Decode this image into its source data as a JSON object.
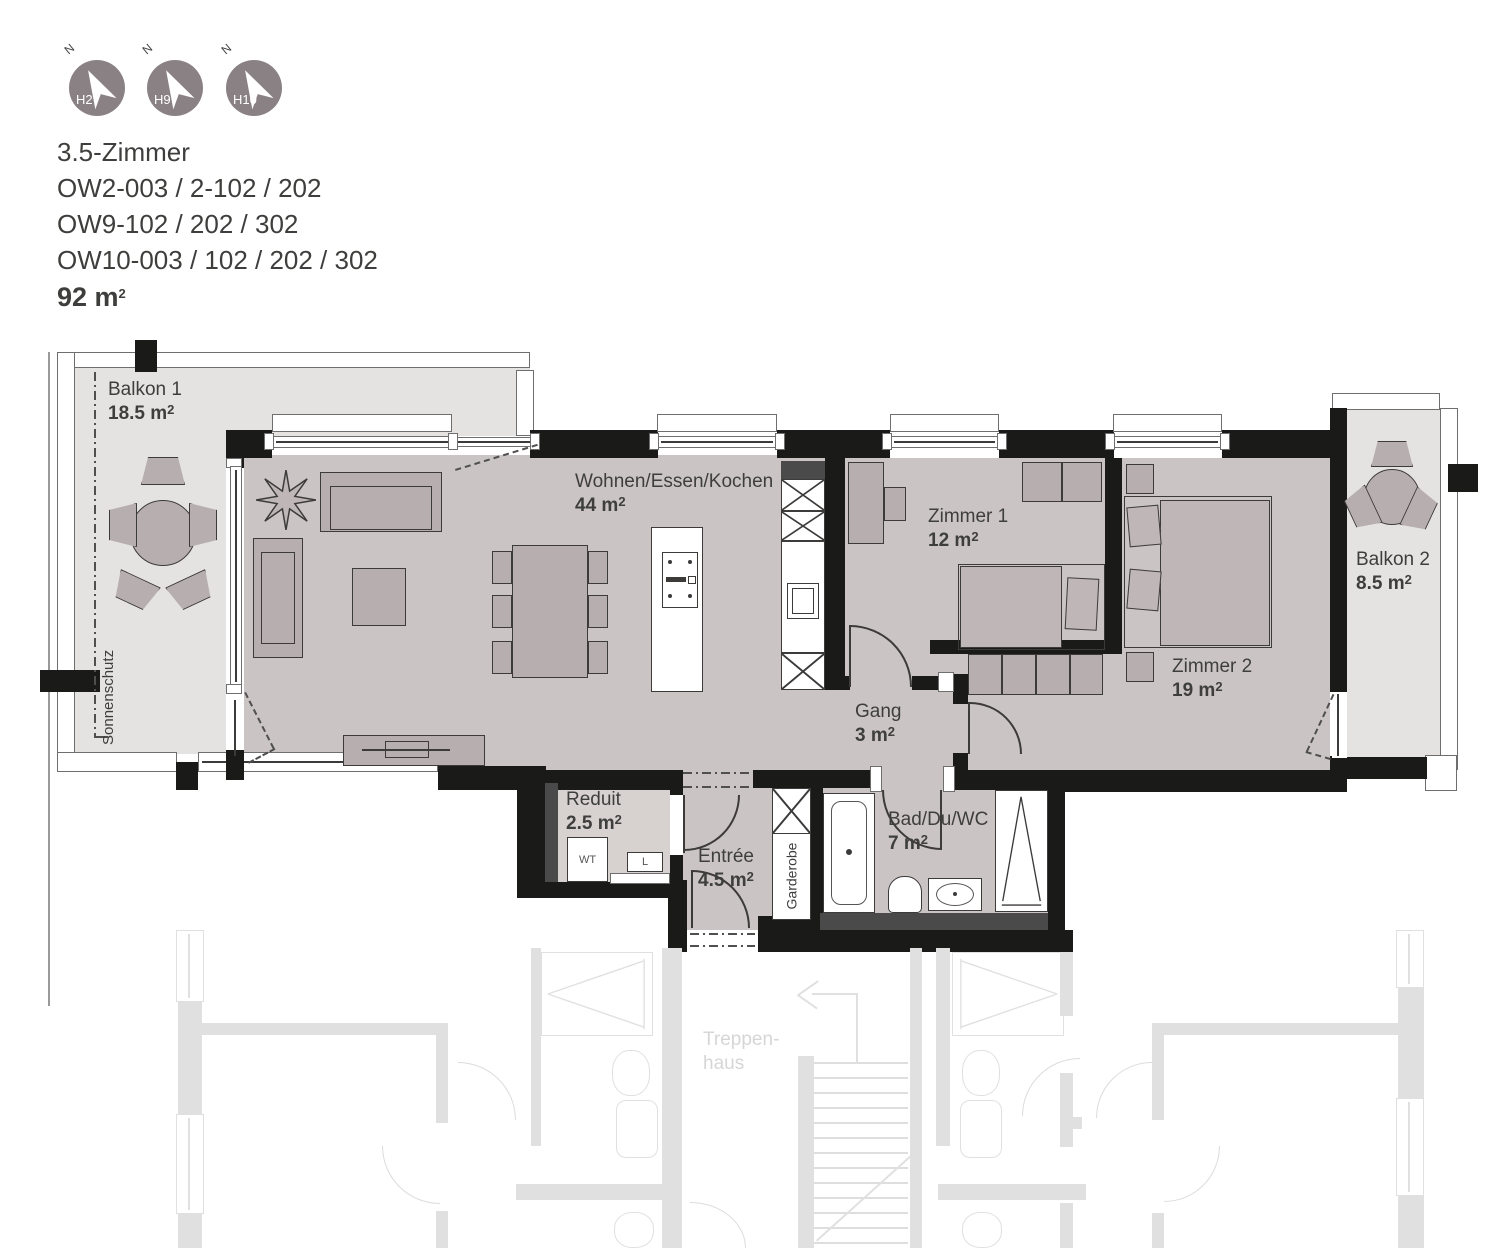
{
  "header": {
    "compass": {
      "north": "N",
      "units": [
        {
          "label": "H2"
        },
        {
          "label": "H9"
        },
        {
          "label": "H10"
        }
      ]
    },
    "title": "3.5-Zimmer",
    "lines": [
      "OW2-003 / 2-102 / 202",
      "OW9-102 / 202 / 302",
      "OW10-003 / 102 / 202 / 302"
    ],
    "area": {
      "value": "92 m",
      "sup": "2"
    }
  },
  "rooms": {
    "balkon1": {
      "name": "Balkon 1",
      "area": "18.5 m",
      "sup": "2"
    },
    "wohnen": {
      "name": "Wohnen/Essen/Kochen",
      "area": "44 m",
      "sup": "2"
    },
    "zimmer1": {
      "name": "Zimmer 1",
      "area": "12 m",
      "sup": "2"
    },
    "zimmer2": {
      "name": "Zimmer 2",
      "area": "19 m",
      "sup": "2"
    },
    "balkon2": {
      "name": "Balkon 2",
      "area": "8.5 m",
      "sup": "2"
    },
    "gang": {
      "name": "Gang",
      "area": "3 m",
      "sup": "2"
    },
    "reduit": {
      "name": "Reduit",
      "area": "2.5 m",
      "sup": "2"
    },
    "entree": {
      "name": "Entrée",
      "area": "4.5 m",
      "sup": "2"
    },
    "bad": {
      "name": "Bad/Du/WC",
      "area": "7 m",
      "sup": "2"
    }
  },
  "labels": {
    "sonnenschutz": "Sonnenschutz",
    "garderobe": "Garderobe",
    "wt": "WT",
    "l": "L",
    "treppenhaus_line1": "Treppen-",
    "treppenhaus_line2": "haus"
  },
  "colors": {
    "wall": "#1a1a18",
    "floor": "#cbc4c5",
    "floor-light": "#d7d1cf",
    "balcony": "#e5e3e2",
    "furniture": "#b6aeaf",
    "furniture-soft": "#beb6b7",
    "outline": "#3d3a3a",
    "dark": "#4b4a4a",
    "faded": "#e0e0e0",
    "faded-text": "#d6d6d6",
    "compass": "#8a8185",
    "text": "#3e3e3c"
  }
}
